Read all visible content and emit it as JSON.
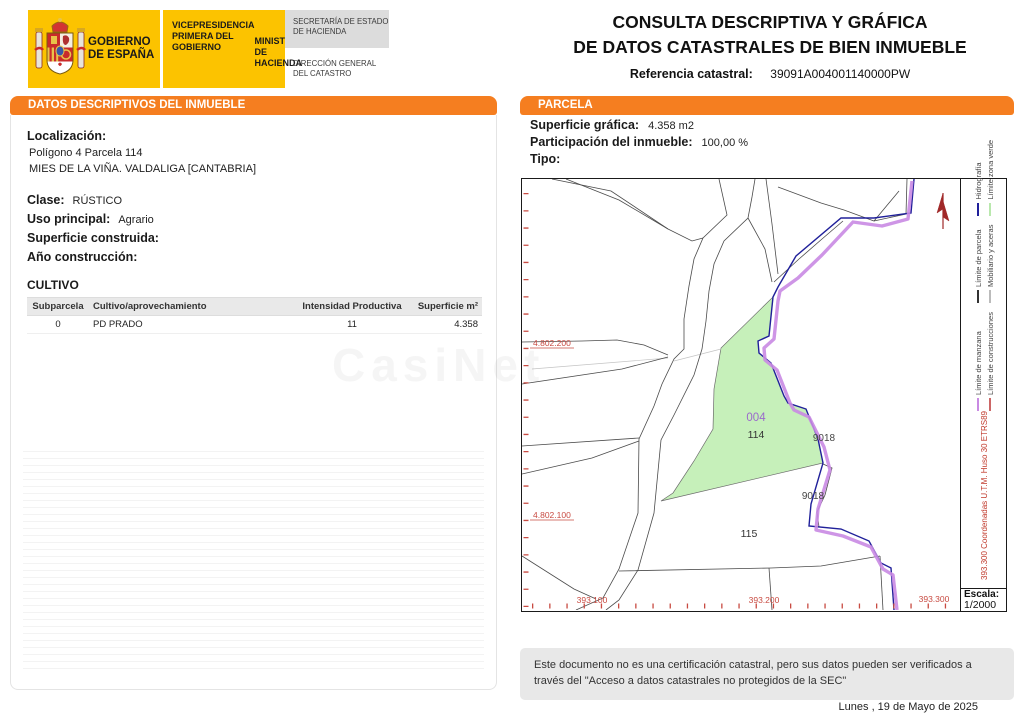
{
  "header": {
    "logo": {
      "gobierno_line1": "GOBIERNO",
      "gobierno_line2": "DE ESPAÑA",
      "vice_line1": "VICEPRESIDENCIA",
      "vice_line2": "PRIMERA DEL GOBIERNO",
      "ministerio_line1": "MINISTERIO",
      "ministerio_line2": "DE HACIENDA",
      "secretaria_line1": "SECRETARÍA DE ESTADO",
      "secretaria_line2": "DE HACIENDA",
      "direccion_line1": "DIRECCIÓN GENERAL",
      "direccion_line2": "DEL CATASTRO",
      "yellow": "#FCC300",
      "gray": "#DCDCDC"
    },
    "title_line1": "CONSULTA DESCRIPTIVA Y GRÁFICA",
    "title_line2": "DE DATOS CATASTRALES DE BIEN INMUEBLE",
    "ref_label": "Referencia catastral:",
    "ref_value": "39091A004001140000PW"
  },
  "left_panel": {
    "header": "DATOS DESCRIPTIVOS DEL INMUEBLE",
    "localizacion_label": "Localización:",
    "localizacion_line1": "Polígono 4 Parcela 114",
    "localizacion_line2": "MIES DE LA VIÑA. VALDALIGA [CANTABRIA]",
    "clase_label": "Clase:",
    "clase_value": "RÚSTICO",
    "uso_label": "Uso principal:",
    "uso_value": "Agrario",
    "superficie_label": "Superficie construida:",
    "superficie_value": "",
    "ano_label": "Año construcción:",
    "ano_value": "",
    "cultivo_title": "CULTIVO",
    "cultivo_table": {
      "headers": [
        "Subparcela",
        "Cultivo/aprovechamiento",
        "Intensidad Productiva",
        "Superficie m²"
      ],
      "rows": [
        [
          "0",
          "PD PRADO",
          "11",
          "4.358"
        ]
      ]
    }
  },
  "right_panel": {
    "header": "PARCELA",
    "superficie_label": "Superficie gráfica:",
    "superficie_value": "4.358 m2",
    "participacion_label": "Participación del inmueble:",
    "participacion_value": "100,00 %",
    "tipo_label": "Tipo:",
    "tipo_value": "",
    "map": {
      "parcel_code": "004",
      "parcel_number": "114",
      "road_label_1": "9018",
      "road_label_2": "9018",
      "neighbor_parcel": "115",
      "coord_y1": "4.802.200",
      "coord_y2": "4.802.100",
      "coord_x1": "393.100",
      "coord_x2": "393.200",
      "coord_x3": "393.300",
      "coord_note": "393.300 Coordenadas U.T.M. Huso 30 ETRS89",
      "escala_label": "Escala:",
      "escala_value": "1/2000",
      "highlight_fill": "#c6f0ba",
      "legend": [
        {
          "label": "Límite de manzana",
          "color": "#c98ae3"
        },
        {
          "label": "Límite de construcciones",
          "color": "#cc6666"
        },
        {
          "label": "Límite de parcela",
          "color": "#333333"
        },
        {
          "label": "Mobiliario y aceras",
          "color": "#bbbbbb"
        },
        {
          "label": "Hidrografía",
          "color": "#20209a"
        },
        {
          "label": "Límite zona verde",
          "color": "#b9e8ad"
        }
      ]
    }
  },
  "footer": {
    "disclaimer": "Este documento no es una certificación catastral, pero sus datos pueden ser verificados a través del \"Acceso a datos catastrales no protegidos de la SEC\"",
    "date": "Lunes , 19 de Mayo de 2025"
  },
  "watermark": "CasiNet"
}
